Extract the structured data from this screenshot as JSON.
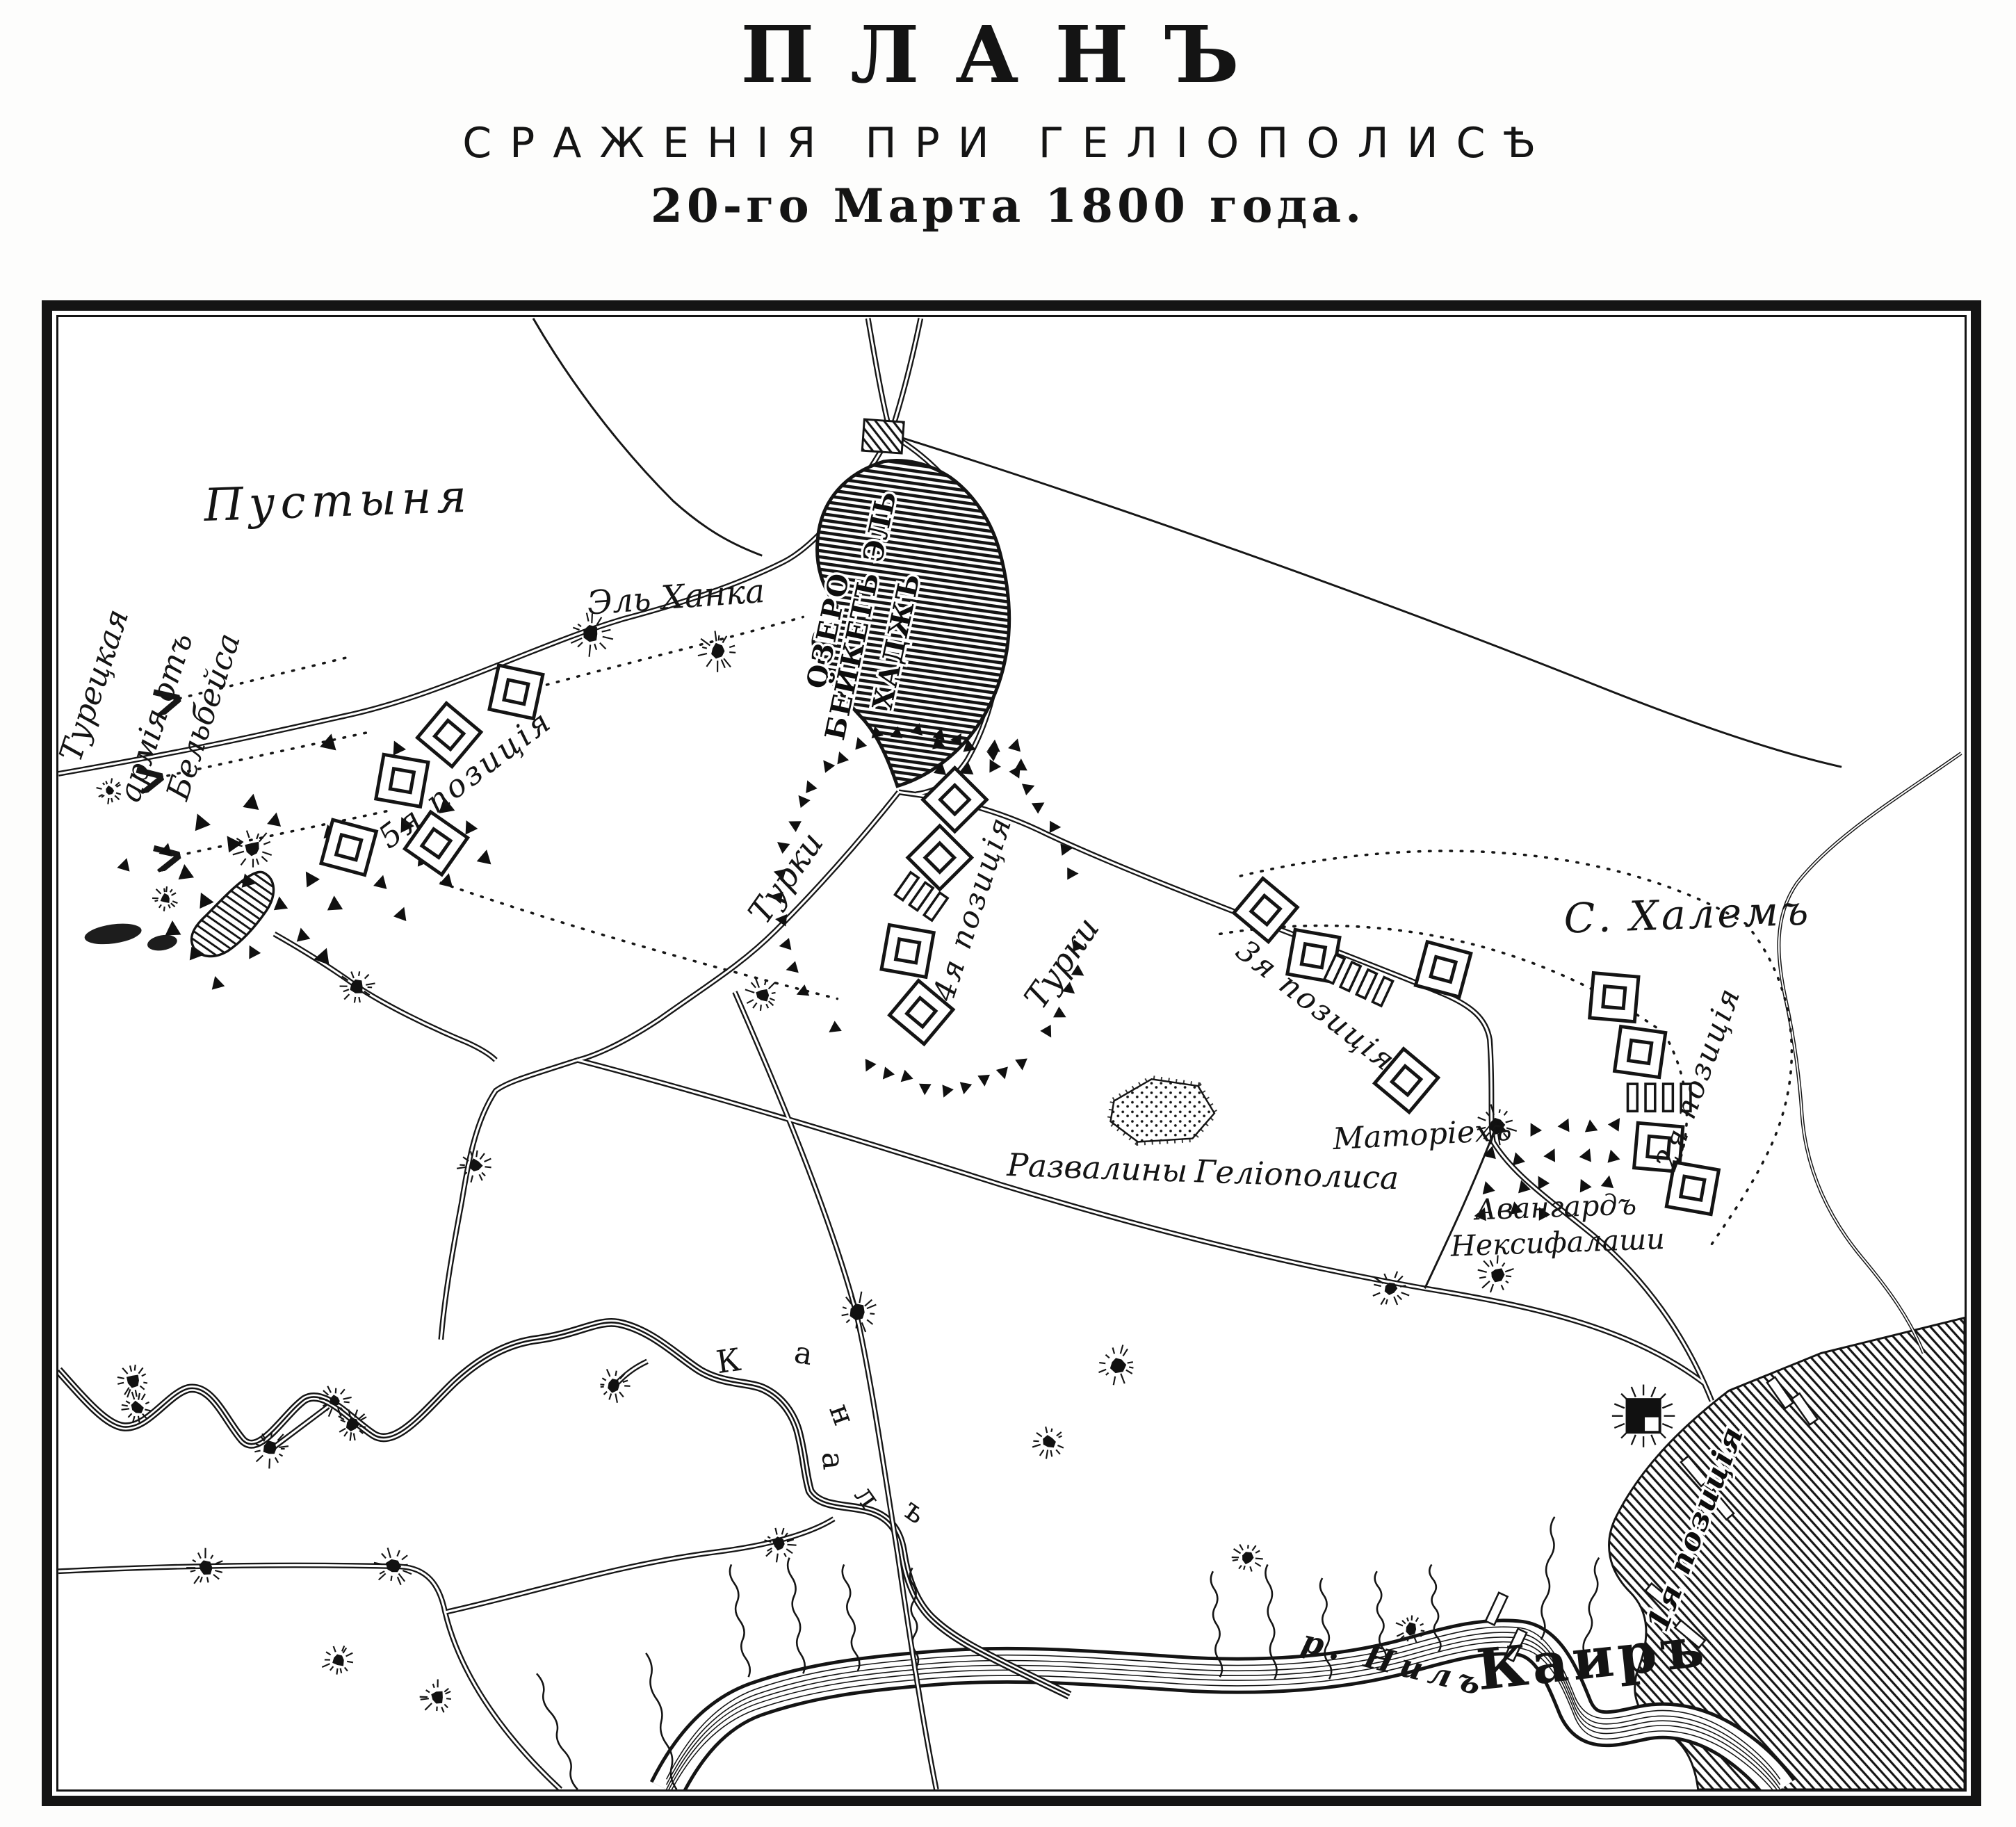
{
  "title": {
    "main": "ПЛАНЪ",
    "subtitle": "СРАЖЕНІЯ ПРИ ГЕЛІОПОЛИСѢ",
    "date": "20-го Марта 1800 года."
  },
  "map": {
    "labels": {
      "desert": "Пустыня",
      "turkish_army_line1": "Турецкая",
      "turkish_army_line2": "армія отъ",
      "turkish_army_line3": "Бельбейса",
      "el_khanka": "Эль Ханка",
      "lake_line1": "ОЗЕРО",
      "lake_line2": "БЕЙКЕТЪ ЭЛЬ",
      "lake_line3": "ХАДЖЪ",
      "turks_west": "Турки",
      "turks_east": "Турки",
      "s_khalem": "С. Халемъ",
      "matarieh": "Маторіехъ",
      "ruins_line1": "Развалины",
      "ruins_line2": "Геліополиса",
      "avantgarde_line1": "Авангардъ",
      "avantgarde_line2": "Нексифалаши",
      "nile": "р. Нилъ",
      "cairo": "Каиръ"
    },
    "canal_letters": [
      "К",
      "а",
      "н",
      "а",
      "л",
      "ъ"
    ],
    "positions": {
      "p1": "1я позиція",
      "p2": "2я позиція",
      "p3": "3я позиція",
      "p4": "4я позиція",
      "p5": "5я позиція"
    },
    "ink_color": "#141414",
    "paper_color": "#ffffff"
  }
}
